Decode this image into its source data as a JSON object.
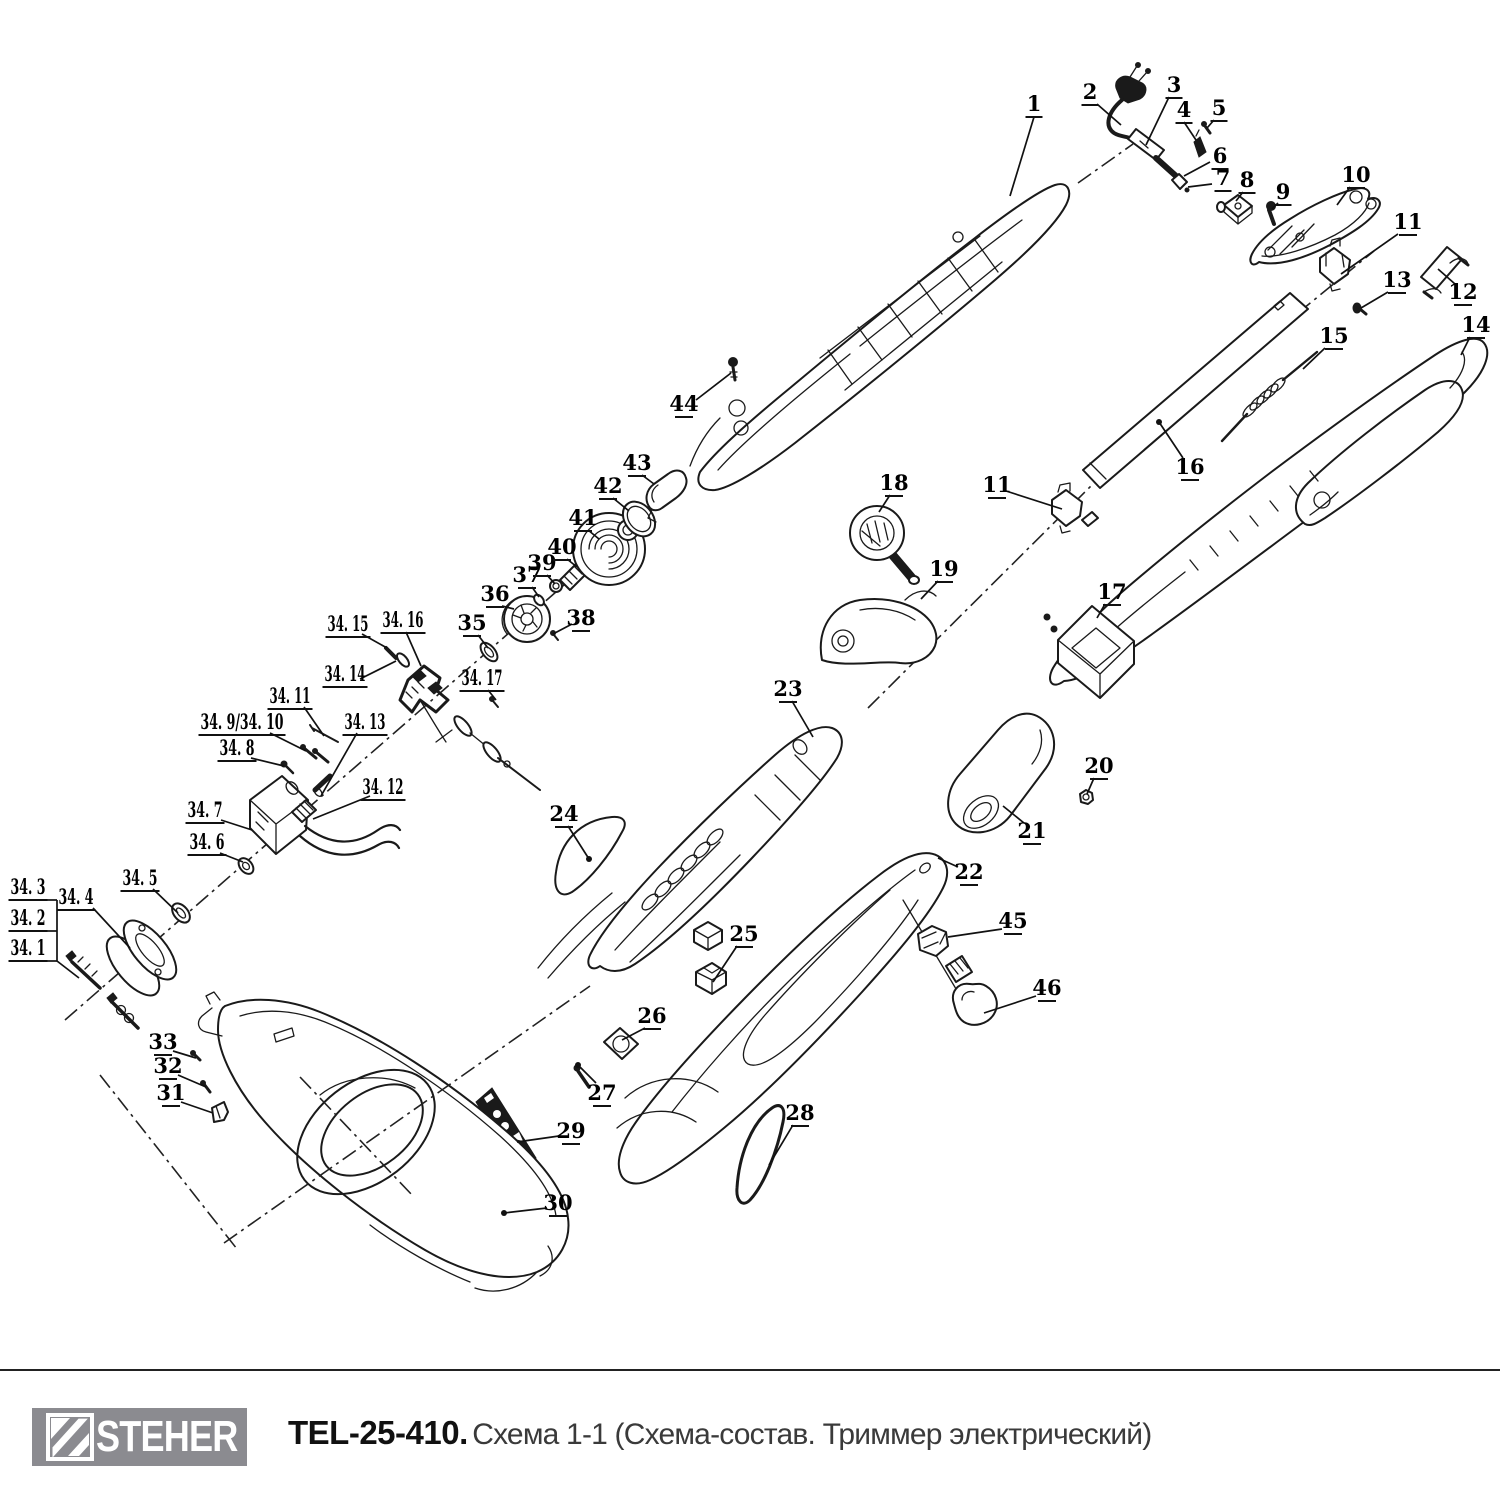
{
  "footer": {
    "brand": "STEHER",
    "model": "TEL-25-410.",
    "subtitle": "Схема 1-1 (Схема-состав. Триммер электрический)",
    "logo_bg": "#8b8b90",
    "rule_color": "#222222"
  },
  "diagram": {
    "stroke": "#1a1a1a",
    "labels": [
      {
        "t": "1",
        "x": 1034,
        "y": 103,
        "lead": [
          [
            1034,
            117
          ],
          [
            1010,
            196
          ]
        ]
      },
      {
        "t": "2",
        "x": 1090,
        "y": 91,
        "lead": [
          [
            1097,
            104
          ],
          [
            1121,
            125
          ]
        ]
      },
      {
        "t": "3",
        "x": 1174,
        "y": 84,
        "lead": [
          [
            1169,
            97
          ],
          [
            1146,
            145
          ]
        ]
      },
      {
        "t": "4",
        "x": 1184,
        "y": 109,
        "lead": [
          [
            1184,
            122
          ],
          [
            1196,
            140
          ]
        ]
      },
      {
        "t": "5",
        "x": 1219,
        "y": 107,
        "lead": [
          [
            1214,
            120
          ],
          [
            1207,
            128
          ]
        ]
      },
      {
        "t": "6",
        "x": 1220,
        "y": 155,
        "lead": [
          [
            1210,
            162
          ],
          [
            1184,
            176
          ]
        ]
      },
      {
        "t": "7",
        "x": 1223,
        "y": 177,
        "lead": [
          [
            1212,
            184
          ],
          [
            1188,
            187
          ]
        ]
      },
      {
        "t": "8",
        "x": 1247,
        "y": 179,
        "lead": [
          [
            1243,
            192
          ],
          [
            1236,
            201
          ]
        ]
      },
      {
        "t": "9",
        "x": 1283,
        "y": 191,
        "lead": [
          [
            1278,
            203
          ],
          [
            1272,
            209
          ]
        ]
      },
      {
        "t": "10",
        "x": 1356,
        "y": 174,
        "lead": [
          [
            1350,
            187
          ],
          [
            1337,
            205
          ]
        ]
      },
      {
        "t": "11",
        "x": 1408,
        "y": 221,
        "lead": [
          [
            1398,
            234
          ],
          [
            1341,
            274
          ]
        ]
      },
      {
        "t": "12",
        "x": 1463,
        "y": 291,
        "lead": [
          [
            1455,
            284
          ],
          [
            1438,
            269
          ]
        ]
      },
      {
        "t": "13",
        "x": 1397,
        "y": 279,
        "lead": [
          [
            1388,
            292
          ],
          [
            1361,
            308
          ]
        ]
      },
      {
        "t": "14",
        "x": 1476,
        "y": 324,
        "lead": [
          [
            1470,
            337
          ],
          [
            1461,
            355
          ]
        ]
      },
      {
        "t": "15",
        "x": 1334,
        "y": 335,
        "lead": [
          [
            1325,
            348
          ],
          [
            1303,
            369
          ]
        ]
      },
      {
        "t": "16",
        "x": 1190,
        "y": 466,
        "lead": [
          [
            1183,
            458
          ],
          [
            1159,
            422
          ]
        ],
        "dot": true
      },
      {
        "t": "17",
        "x": 1112,
        "y": 591,
        "lead": [
          [
            1105,
            604
          ],
          [
            1097,
            618
          ]
        ]
      },
      {
        "t": "18",
        "x": 894,
        "y": 482,
        "lead": [
          [
            890,
            495
          ],
          [
            879,
            512
          ]
        ]
      },
      {
        "t": "19",
        "x": 944,
        "y": 568,
        "lead": [
          [
            938,
            581
          ],
          [
            921,
            599
          ]
        ]
      },
      {
        "t": "20",
        "x": 1099,
        "y": 765,
        "lead": [
          [
            1094,
            778
          ],
          [
            1087,
            794
          ]
        ]
      },
      {
        "t": "21",
        "x": 1032,
        "y": 830,
        "lead": [
          [
            1024,
            823
          ],
          [
            1003,
            806
          ]
        ]
      },
      {
        "t": "22",
        "x": 969,
        "y": 871,
        "lead": [
          [
            958,
            867
          ],
          [
            938,
            858
          ]
        ]
      },
      {
        "t": "23",
        "x": 788,
        "y": 688,
        "lead": [
          [
            792,
            701
          ],
          [
            813,
            737
          ]
        ]
      },
      {
        "t": "24",
        "x": 564,
        "y": 813,
        "lead": [
          [
            568,
            826
          ],
          [
            589,
            859
          ]
        ],
        "dot": true
      },
      {
        "t": "25",
        "x": 744,
        "y": 933,
        "lead": [
          [
            737,
            946
          ],
          [
            713,
            982
          ]
        ]
      },
      {
        "t": "26",
        "x": 652,
        "y": 1015,
        "lead": [
          [
            645,
            1028
          ],
          [
            622,
            1040
          ]
        ]
      },
      {
        "t": "27",
        "x": 602,
        "y": 1092,
        "lead": [
          [
            596,
            1083
          ],
          [
            578,
            1065
          ]
        ],
        "dot": true
      },
      {
        "t": "28",
        "x": 800,
        "y": 1112,
        "lead": [
          [
            793,
            1125
          ],
          [
            769,
            1165
          ]
        ]
      },
      {
        "t": "29",
        "x": 571,
        "y": 1130,
        "lead": [
          [
            559,
            1136
          ],
          [
            517,
            1142
          ]
        ]
      },
      {
        "t": "30",
        "x": 558,
        "y": 1202,
        "lead": [
          [
            547,
            1208
          ],
          [
            504,
            1213
          ]
        ],
        "dot": true
      },
      {
        "t": "31",
        "x": 171,
        "y": 1092,
        "lead": [
          [
            181,
            1102
          ],
          [
            213,
            1113
          ]
        ]
      },
      {
        "t": "32",
        "x": 168,
        "y": 1065,
        "lead": [
          [
            178,
            1075
          ],
          [
            206,
            1087
          ]
        ]
      },
      {
        "t": "33",
        "x": 163,
        "y": 1041,
        "lead": [
          [
            173,
            1051
          ],
          [
            196,
            1058
          ]
        ]
      },
      {
        "t": "44",
        "x": 684,
        "y": 403,
        "lead": [
          [
            696,
            400
          ],
          [
            731,
            373
          ]
        ]
      },
      {
        "t": "45",
        "x": 1013,
        "y": 920,
        "lead": [
          [
            1002,
            929
          ],
          [
            948,
            937
          ]
        ]
      },
      {
        "t": "46",
        "x": 1047,
        "y": 987,
        "lead": [
          [
            1036,
            996
          ],
          [
            984,
            1013
          ]
        ]
      },
      {
        "t": "34. 3",
        "x": 28,
        "y": 886,
        "lead": [
          [
            46,
            900
          ],
          [
            57,
            900
          ]
        ]
      },
      {
        "t": "34. 2",
        "x": 28,
        "y": 917,
        "lead": [
          [
            46,
            931
          ],
          [
            57,
            931
          ]
        ]
      },
      {
        "t": "34. 1",
        "x": 28,
        "y": 947,
        "lead": [
          [
            46,
            961
          ],
          [
            57,
            961
          ]
        ]
      },
      {
        "t": "34. 4",
        "x": 76,
        "y": 896,
        "lead": [
          [
            93,
            908
          ],
          [
            130,
            948
          ]
        ]
      },
      {
        "t": "34. 5",
        "x": 140,
        "y": 877,
        "lead": [
          [
            153,
            889
          ],
          [
            178,
            913
          ]
        ]
      },
      {
        "t": "34. 6",
        "x": 207,
        "y": 841,
        "lead": [
          [
            220,
            853
          ],
          [
            243,
            862
          ]
        ]
      },
      {
        "t": "34. 7",
        "x": 205,
        "y": 809,
        "lead": [
          [
            221,
            820
          ],
          [
            252,
            830
          ]
        ]
      },
      {
        "t": "34. 8",
        "x": 237,
        "y": 747,
        "lead": [
          [
            251,
            758
          ],
          [
            284,
            766
          ]
        ]
      },
      {
        "t": "34. 9/34. 10",
        "x": 242,
        "y": 721,
        "lead": [
          [
            270,
            733
          ],
          [
            306,
            751
          ]
        ]
      },
      {
        "t": "34. 11",
        "x": 290,
        "y": 695,
        "lead": [
          [
            304,
            707
          ],
          [
            324,
            736
          ]
        ]
      },
      {
        "t": "34. 12",
        "x": 383,
        "y": 786,
        "lead": [
          [
            370,
            796
          ],
          [
            313,
            819
          ]
        ]
      },
      {
        "t": "34. 13",
        "x": 365,
        "y": 721,
        "lead": [
          [
            357,
            733
          ],
          [
            321,
            796
          ]
        ]
      },
      {
        "t": "34. 14",
        "x": 345,
        "y": 673,
        "lead": [
          [
            360,
            679
          ],
          [
            396,
            661
          ]
        ]
      },
      {
        "t": "34. 15",
        "x": 348,
        "y": 623,
        "lead": [
          [
            362,
            634
          ],
          [
            387,
            648
          ]
        ]
      },
      {
        "t": "34. 16",
        "x": 403,
        "y": 619,
        "lead": [
          [
            406,
            632
          ],
          [
            421,
            666
          ]
        ]
      },
      {
        "t": "34. 17",
        "x": 482,
        "y": 677,
        "lead": [
          [
            488,
            690
          ],
          [
            496,
            700
          ]
        ]
      },
      {
        "t": "35",
        "x": 472,
        "y": 622,
        "lead": [
          [
            478,
            635
          ],
          [
            488,
            648
          ]
        ]
      },
      {
        "t": "36",
        "x": 495,
        "y": 593,
        "lead": [
          [
            502,
            606
          ],
          [
            514,
            609
          ]
        ]
      },
      {
        "t": "37",
        "x": 527,
        "y": 574,
        "lead": [
          [
            532,
            587
          ],
          [
            539,
            597
          ]
        ]
      },
      {
        "t": "38",
        "x": 581,
        "y": 617,
        "lead": [
          [
            572,
            624
          ],
          [
            553,
            634
          ]
        ]
      },
      {
        "t": "39",
        "x": 542,
        "y": 562,
        "lead": [
          [
            547,
            575
          ],
          [
            555,
            584
          ]
        ]
      },
      {
        "t": "40",
        "x": 562,
        "y": 546,
        "lead": [
          [
            567,
            559
          ],
          [
            577,
            567
          ]
        ]
      },
      {
        "t": "41",
        "x": 583,
        "y": 517,
        "lead": [
          [
            588,
            530
          ],
          [
            599,
            539
          ]
        ]
      },
      {
        "t": "42",
        "x": 608,
        "y": 485,
        "lead": [
          [
            613,
            498
          ],
          [
            629,
            511
          ]
        ]
      },
      {
        "t": "43",
        "x": 637,
        "y": 462,
        "lead": [
          [
            642,
            475
          ],
          [
            654,
            484
          ]
        ]
      },
      {
        "t": "11",
        "x": 997,
        "y": 484,
        "lead": [
          [
            1006,
            491
          ],
          [
            1062,
            509
          ]
        ]
      }
    ]
  }
}
